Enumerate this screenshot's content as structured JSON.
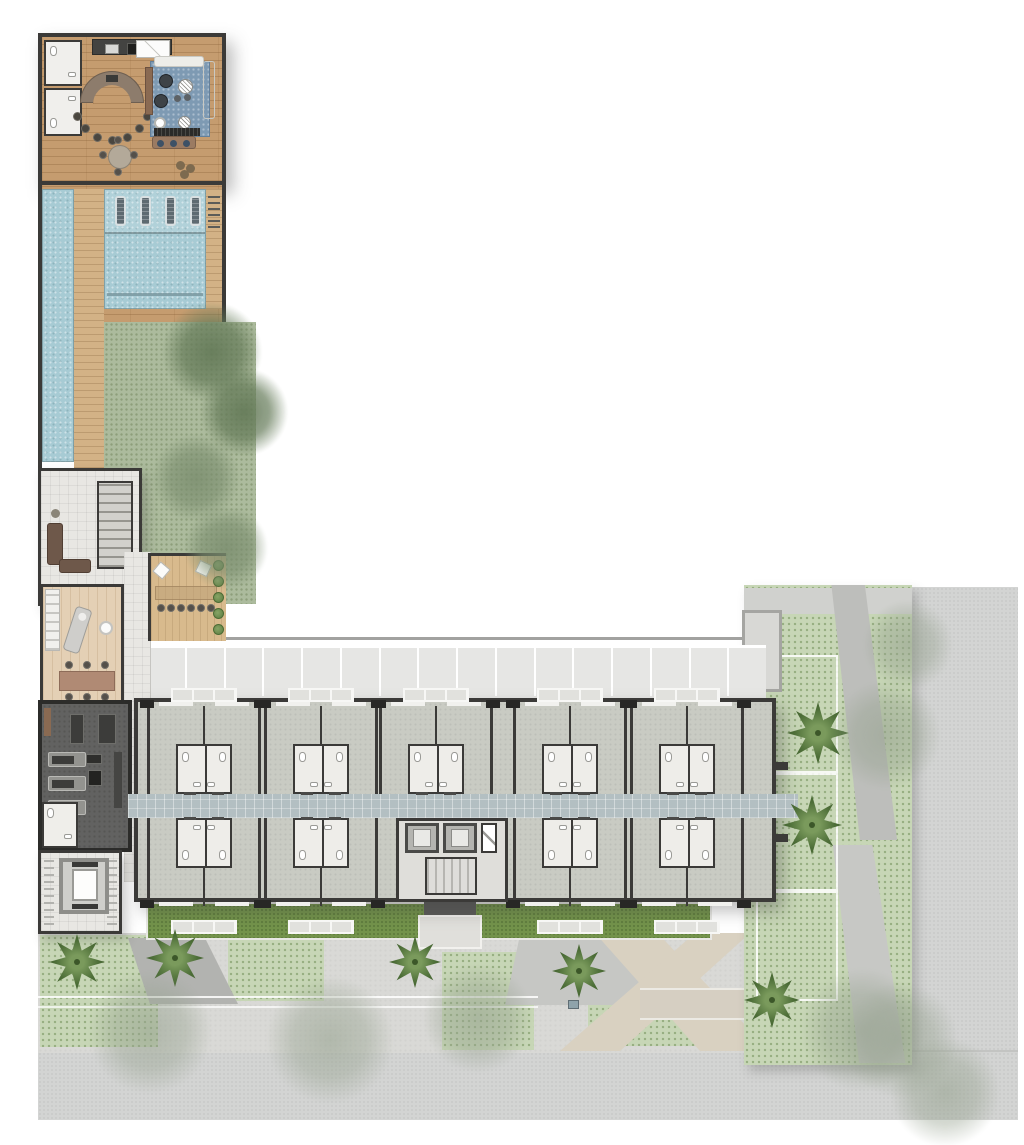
{
  "plan_type": "residential-site-floor-plan",
  "palette": {
    "wall": "#3b3a38",
    "wood": "#c59c6f",
    "woodLine": "rgba(122,82,44,0.28)",
    "spaWood": "#e4d0b5",
    "deck": "#d3b286",
    "terraceDeck": "#d8ba8d",
    "water": "#a7cbd4",
    "waterShelf": "#b6d6dc",
    "tile": "#e8e7e3",
    "hall": "#e5e4e0",
    "lawn": "#acbb9d",
    "lawnBright": "#73934b",
    "unit": "#c9cbc3",
    "corridor": "#b3bfc2",
    "bath": "#eeede9",
    "core": "#dfdeda",
    "parking": "#e6e6e4",
    "street": "#d3d4d3",
    "yard": "#d9d9d6",
    "pathBeige": "#d9d1c1",
    "ground": "#c7d6b6",
    "gym": "#626261",
    "rug": "#7e9ab3",
    "brown": "#9b7b62",
    "palm": "#4c6d37",
    "palmLight": "#7a9a5c",
    "propertyLine": "#a2a2a0"
  },
  "parking": {
    "stall_count": 16
  },
  "building": {
    "top_pair_centers": [
      200,
      317,
      432,
      566,
      683
    ],
    "bottom_pair_centers": [
      200,
      317,
      566,
      683
    ],
    "pair_width": 114,
    "bath_width": 56,
    "bath_height": 50
  },
  "pool": {
    "lounger_count": 4
  },
  "bar": {
    "stool_count": 7
  },
  "gym": {
    "treadmill_count": 3
  },
  "terrace": {
    "shrub_count": 5,
    "chair_count": 6
  },
  "trees": {
    "lawn": [
      [
        212,
        352,
        50,
        "dark"
      ],
      [
        244,
        412,
        44,
        "dark"
      ],
      [
        196,
        478,
        44,
        "green"
      ],
      [
        226,
        548,
        42,
        "green"
      ]
    ],
    "yard_faded": [
      [
        150,
        1032,
        62
      ],
      [
        330,
        1040,
        64
      ],
      [
        478,
        1018,
        55
      ],
      [
        862,
        1030,
        62
      ],
      [
        945,
        1092,
        55
      ]
    ],
    "garden_faded": [
      [
        886,
        735,
        55
      ],
      [
        908,
        645,
        45
      ],
      [
        900,
        1040,
        58
      ]
    ],
    "yard_palms": [
      [
        77,
        962,
        56
      ],
      [
        175,
        958,
        58
      ],
      [
        415,
        962,
        52
      ],
      [
        579,
        971,
        54
      ]
    ],
    "garden_palms": [
      [
        818,
        733,
        62
      ],
      [
        812,
        825,
        60
      ],
      [
        772,
        1000,
        56
      ]
    ]
  }
}
